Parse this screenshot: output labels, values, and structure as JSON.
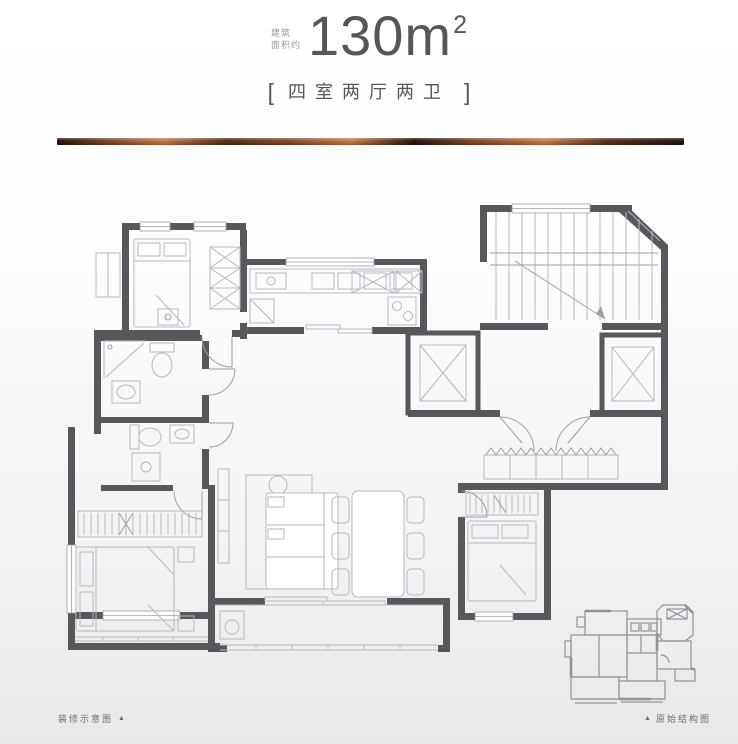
{
  "header": {
    "area_note_line1": "建筑",
    "area_note_line2": "面积约",
    "area_value": "130m",
    "area_superscript": "2",
    "bracket_open": "[",
    "layout_label": "四室两厅两卫",
    "bracket_close": "]"
  },
  "footer": {
    "left_label": "装修示意图",
    "left_marker": "▲",
    "right_marker": "▲",
    "right_label": "原始结构图"
  },
  "floorplan": {
    "kind": "apartment-floor-plan",
    "features": [
      "bedrooms:4",
      "living-dining",
      "kitchen",
      "bathrooms:2",
      "balconies",
      "entry-foyer",
      "elevators:2",
      "stairwell",
      "mini-original-structure-plan"
    ]
  },
  "colors": {
    "wall": "#57585c",
    "furniture": "#b3bac2",
    "furniture_dark": "#99a0a8",
    "title_text": "#55565a",
    "note_text": "#9b9b9b",
    "footer_text": "#6e6e6e",
    "miniplan": "#8e939a",
    "bg_top": "#ffffff",
    "bg_bottom": "#e9e9e9",
    "copper_1": "#2a160e",
    "copper_2": "#8a4e2e",
    "copper_3": "#c9804f",
    "copper_4": "#58301c"
  }
}
